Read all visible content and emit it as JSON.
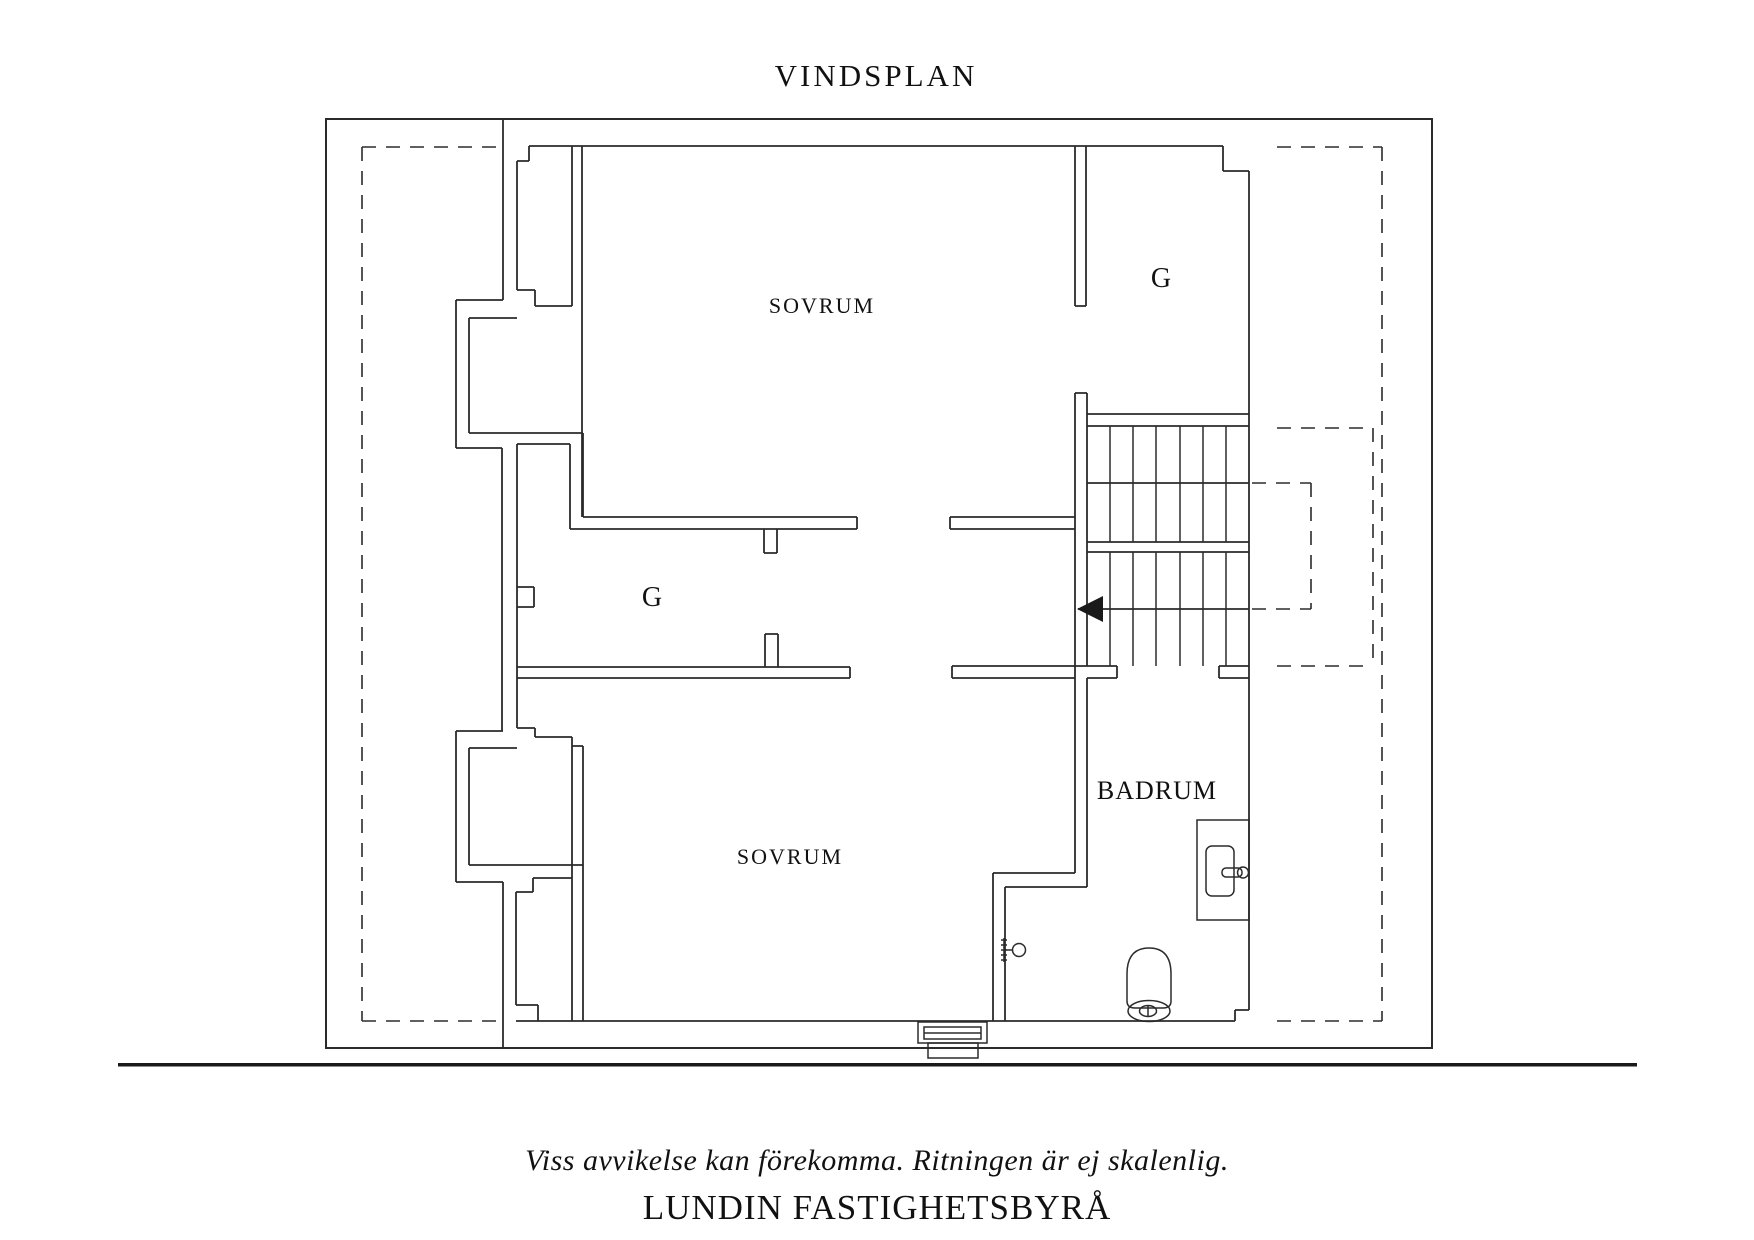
{
  "title": "VINDSPLAN",
  "plan": {
    "floor_name": "VINDSPLAN",
    "rooms": [
      {
        "id": "sovrum-top",
        "label": "SOVRUM"
      },
      {
        "id": "closet-top-right",
        "label": "G"
      },
      {
        "id": "closet-left",
        "label": "G"
      },
      {
        "id": "sovrum-bottom",
        "label": "SOVRUM"
      },
      {
        "id": "badrum",
        "label": "BADRUM"
      }
    ],
    "features": {
      "stairs": {
        "runs": 2,
        "direction_arrow": "left"
      },
      "fixtures": [
        "toilet",
        "sink",
        "door-handle",
        "window"
      ],
      "dashed_lines": "low-ceiling / roof boundary markings"
    }
  },
  "footer": {
    "disclaimer": "Viss avvikelse kan förekomma. Ritningen är ej skalenlig.",
    "brand": "LUNDIN FASTIGHETSBYRÅ"
  },
  "colors": {
    "line": "#2b2b2b",
    "text": "#111111",
    "background": "#ffffff"
  }
}
